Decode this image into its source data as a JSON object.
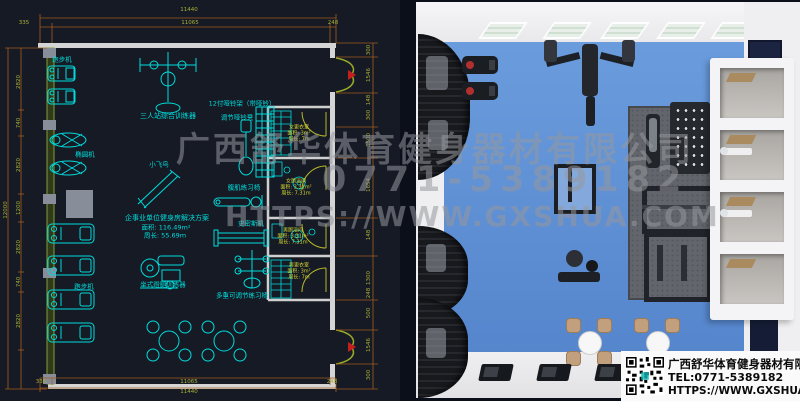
{
  "cad": {
    "dim_top_total": "11440",
    "dim_top_segments": [
      "335",
      "11065",
      "248"
    ],
    "dim_bottom_segments": [
      "335",
      "11065",
      "248"
    ],
    "dim_bottom_total": "11440",
    "dim_left_total": "12000",
    "dim_left_chain": [
      "2820",
      "740",
      "2820",
      "1200",
      "2820",
      "740",
      "2820"
    ],
    "dim_right_chain": [
      "300",
      "1546",
      "148",
      "300",
      "1500",
      "1654",
      "148",
      "1300",
      "248",
      "500",
      "1546",
      "300"
    ],
    "labels": {
      "treadmill_top": "跑步机",
      "elliptical": "椭圆机",
      "treadmill_bottom": "跑步机",
      "multi_station": "三人站综合训练器",
      "cable_fly": "小飞鸟",
      "dumbbell_rack": "12付哑铃架（带哑铃）",
      "dumbbell_bench": "调节哑铃凳",
      "ab_bench": "腹肌练习椅",
      "smith_machine": "史密斯机",
      "adjustable_bench": "多重可调节练习椅",
      "leg_press": "坐式蹬腿训练器"
    },
    "solution": {
      "title": "企事业单位健身房解决方案",
      "area": "面积: 116.49m²",
      "perimeter": "周长: 55.69m"
    },
    "rooms": [
      {
        "name": "女更衣室",
        "area": "面积: 3m²",
        "perimeter": "周长: 7m"
      },
      {
        "name": "女厕浴间",
        "area": "面积: 3.31m²",
        "perimeter": "周长: 7.31m"
      },
      {
        "name": "男厕浴间",
        "area": "面积: 3.31m²",
        "perimeter": "周长: 7.31m"
      },
      {
        "name": "男更衣室",
        "area": "面积: 3m²",
        "perimeter": "周长: 7m"
      }
    ]
  },
  "watermark": {
    "company": "广西舒华体育健身器材有限公司",
    "phone": "0771-5389182",
    "website": "HTTPS://WWW.GXSHUA.COM"
  },
  "info_card": {
    "company": "广西舒华体育健身器材有限公司",
    "tel": "TEL:0771-5389182",
    "url": "HTTPS://WWW.GXSHUA.COM"
  },
  "colors": {
    "cad_equipment": "#00dcdc",
    "cad_dim_line": "#a55d1e",
    "cad_dim_text": "#a8b038",
    "room_label": "#d8d832",
    "floor_blue": "#5f92d4",
    "cad_background": "#151a24"
  }
}
